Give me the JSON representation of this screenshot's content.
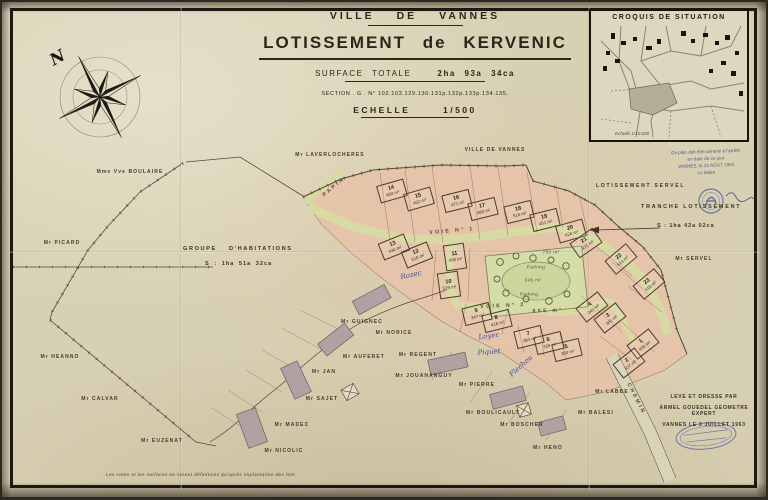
{
  "palette": {
    "paper": "#d8d0b3",
    "lots_pink": "#e7c2a8",
    "road_green": "#d7daa2",
    "place_green": "#ccd69c",
    "ink": "#2c261d",
    "blue_ink": "#3b4fa0",
    "stamp_blue": "#4a569b"
  },
  "header": {
    "city": "VILLE DE VANNES",
    "title": "LOTISSEMENT de KERVENIC",
    "surface_label": "SURFACE TOTALE",
    "surface_value": "2ha 93a 34ca",
    "section": "SECTION . G . N° 102.103.129.130.131p.132p.133p.134.135.",
    "scale_label": "ECHELLE",
    "scale_value": "1/500"
  },
  "croquis": {
    "title": "CROQUIS DE SITUATION",
    "scale_note": "Echelle 1/10.000"
  },
  "compass": {
    "north_label": "N"
  },
  "areas": {
    "groupe": {
      "title": "GROUPE D'HABITATIONS",
      "area": "S : 1ha 51a 32ca"
    },
    "tranche": {
      "title": "TRANCHE LOTISSEMENT",
      "area": "S : 1ha 42a 02ca"
    },
    "servel_label": "LOTISSEMENT SERVEL"
  },
  "surveyor": {
    "lines": [
      "LEVE ET DRESSE PAR",
      "ARMEL GOUEDEL GEOMETRE EXPERT",
      "VANNES LE 3 JUILLET 1963"
    ]
  },
  "approval": {
    "lines": [
      "Ce plan doit être annexé à l'arrêté",
      "en date de ce jour",
      "VANNES, le 23 AOUT 1963",
      "Le Maire"
    ]
  },
  "footnote": {
    "text": "Les cotes et les surfaces ne seront définitives qu'après implantation des lots"
  },
  "lots": [
    {
      "n": "1",
      "area": "458 m²",
      "x": 643,
      "y": 344,
      "rot": -38
    },
    {
      "n": "2",
      "area": "437 m²",
      "x": 629,
      "y": 363,
      "rot": -38
    },
    {
      "n": "3",
      "area": "381 m²",
      "x": 610,
      "y": 318,
      "rot": -38
    },
    {
      "n": "4",
      "area": "342 m²",
      "x": 592,
      "y": 307,
      "rot": -38
    },
    {
      "n": "5",
      "area": "350 m²",
      "x": 567,
      "y": 350,
      "rot": -14
    },
    {
      "n": "6",
      "area": "339 m²",
      "x": 549,
      "y": 343,
      "rot": -14
    },
    {
      "n": "7",
      "area": "383 m²",
      "x": 529,
      "y": 337,
      "rot": -14
    },
    {
      "n": "8",
      "area": "418 m²",
      "x": 497,
      "y": 321,
      "rot": -14
    },
    {
      "n": "9",
      "area": "347 m²",
      "x": 477,
      "y": 314,
      "rot": -14
    },
    {
      "n": "10",
      "area": "519 m²",
      "x": 449,
      "y": 285,
      "rot": -8,
      "w": 19,
      "h": 24
    },
    {
      "n": "11",
      "area": "438 m²",
      "x": 455,
      "y": 257,
      "rot": -8,
      "w": 19,
      "h": 24
    },
    {
      "n": "12",
      "area": "519 m²",
      "x": 417,
      "y": 255,
      "rot": -22
    },
    {
      "n": "13",
      "area": "434 m²",
      "x": 394,
      "y": 247,
      "rot": -22
    },
    {
      "n": "14",
      "area": "484 m²",
      "x": 392,
      "y": 191,
      "rot": -16
    },
    {
      "n": "15",
      "area": "462 m²",
      "x": 419,
      "y": 199,
      "rot": -16
    },
    {
      "n": "16",
      "area": "471 m²",
      "x": 457,
      "y": 201,
      "rot": -14
    },
    {
      "n": "17",
      "area": "460 m²",
      "x": 483,
      "y": 209,
      "rot": -14
    },
    {
      "n": "18",
      "area": "516 m²",
      "x": 519,
      "y": 212,
      "rot": -14
    },
    {
      "n": "19",
      "area": "451 m²",
      "x": 545,
      "y": 220,
      "rot": -14
    },
    {
      "n": "20",
      "area": "426 m²",
      "x": 571,
      "y": 231,
      "rot": -16
    },
    {
      "n": "21",
      "area": "431 m²",
      "x": 586,
      "y": 243,
      "rot": -35
    },
    {
      "n": "22",
      "area": "513 m²",
      "x": 621,
      "y": 259,
      "rot": -40
    },
    {
      "n": "23",
      "area": "418 m²",
      "x": 649,
      "y": 284,
      "rot": -40
    }
  ],
  "neighbors": [
    {
      "name": "Mme Vve BOULAIRE",
      "x": 130,
      "y": 172
    },
    {
      "name": "Mr PICARD",
      "x": 62,
      "y": 243
    },
    {
      "name": "Mr HEANNO",
      "x": 60,
      "y": 357
    },
    {
      "name": "Mr CALVAR",
      "x": 100,
      "y": 399
    },
    {
      "name": "Mr EUZENAT",
      "x": 162,
      "y": 441
    },
    {
      "name": "Mr LAVERLOCHERES",
      "x": 330,
      "y": 155
    },
    {
      "name": "VILLE DE VANNES",
      "x": 495,
      "y": 150
    },
    {
      "name": "Mr GUIGNEC",
      "x": 362,
      "y": 322
    },
    {
      "name": "Mr NORICE",
      "x": 394,
      "y": 333
    },
    {
      "name": "Mr AUFERET",
      "x": 364,
      "y": 357
    },
    {
      "name": "Mr JAN",
      "x": 324,
      "y": 372
    },
    {
      "name": "Mr SAJET",
      "x": 322,
      "y": 399
    },
    {
      "name": "Mr MADEC",
      "x": 292,
      "y": 425
    },
    {
      "name": "Mr NICOLIC",
      "x": 284,
      "y": 451
    },
    {
      "name": "Mr REGENT",
      "x": 418,
      "y": 355
    },
    {
      "name": "Mr JOUANANGUY",
      "x": 424,
      "y": 376
    },
    {
      "name": "Mr PIERRE",
      "x": 477,
      "y": 385
    },
    {
      "name": "Mr BOULICAULT",
      "x": 493,
      "y": 413
    },
    {
      "name": "Mr BOSCHER",
      "x": 522,
      "y": 425
    },
    {
      "name": "Mr HENO",
      "x": 548,
      "y": 448
    },
    {
      "name": "Mr LABBE",
      "x": 612,
      "y": 392
    },
    {
      "name": "Mr BALESI",
      "x": 596,
      "y": 413
    },
    {
      "name": "Mr SERVEL",
      "x": 694,
      "y": 259
    }
  ],
  "streets": [
    {
      "label": "PAPIN",
      "x": 334,
      "y": 187,
      "rot": -40
    },
    {
      "label": "VOIE N° 1",
      "x": 452,
      "y": 231,
      "rot": -5
    },
    {
      "label": "VOIE N° 2",
      "x": 503,
      "y": 306,
      "rot": -3
    },
    {
      "label": "805 m²",
      "x": 548,
      "y": 311,
      "rot": -3
    },
    {
      "label": "CHEMIN",
      "x": 636,
      "y": 399,
      "rot": 63
    }
  ],
  "place_labels": [
    {
      "label": "750 m²",
      "x": 551,
      "y": 252
    },
    {
      "label": "Parking",
      "x": 536,
      "y": 267
    },
    {
      "label": "545 m²",
      "x": 533,
      "y": 280
    },
    {
      "label": "Parking",
      "x": 529,
      "y": 294
    }
  ],
  "blue_notes": [
    {
      "text": "Piquet",
      "x": 489,
      "y": 352,
      "rot": -4
    },
    {
      "text": "Flechou",
      "x": 521,
      "y": 366,
      "rot": -42
    },
    {
      "text": "Rozec",
      "x": 411,
      "y": 275,
      "rot": -12
    },
    {
      "text": "Loyec",
      "x": 489,
      "y": 336,
      "rot": -8
    }
  ]
}
